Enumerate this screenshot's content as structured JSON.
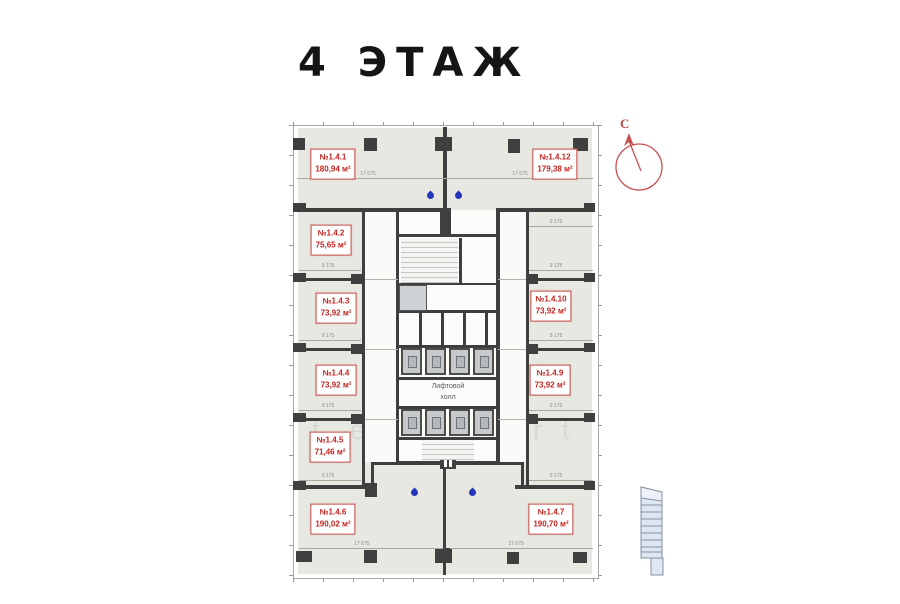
{
  "title": "4 ЭТАЖ",
  "compass": {
    "north_label": "С"
  },
  "core": {
    "hall_label_line1": "Лифтовой",
    "hall_label_line2": "холл"
  },
  "units": [
    {
      "number": "№1.4.1",
      "area": "180,94 м²"
    },
    {
      "number": "№1.4.2",
      "area": "75,65 м²"
    },
    {
      "number": "№1.4.3",
      "area": "73,92 м²"
    },
    {
      "number": "№1.4.4",
      "area": "73,92 м²"
    },
    {
      "number": "№1.4.5",
      "area": "71,46 м²"
    },
    {
      "number": "№1.4.6",
      "area": "190,02 м²"
    },
    {
      "number": "№1.4.7",
      "area": "190,70 м²"
    },
    {
      "number": "№1.4.9",
      "area": "73,92 м²"
    },
    {
      "number": "№1.4.10",
      "area": "73,92 м²"
    },
    {
      "number": "№1.4.12",
      "area": "179,38 м²"
    }
  ],
  "dimensions": {
    "overall_width": "17 675",
    "room_width": "9 175"
  },
  "watermark": {
    "letters": [
      "t",
      "e",
      "r",
      "t"
    ]
  },
  "colors": {
    "floor": "#e8e8e3",
    "wall": "#3f3f3f",
    "unit_label": "#c42420",
    "water_drop": "#2335bb",
    "compass": "#c24848",
    "section_fill": "#dde6f1"
  }
}
